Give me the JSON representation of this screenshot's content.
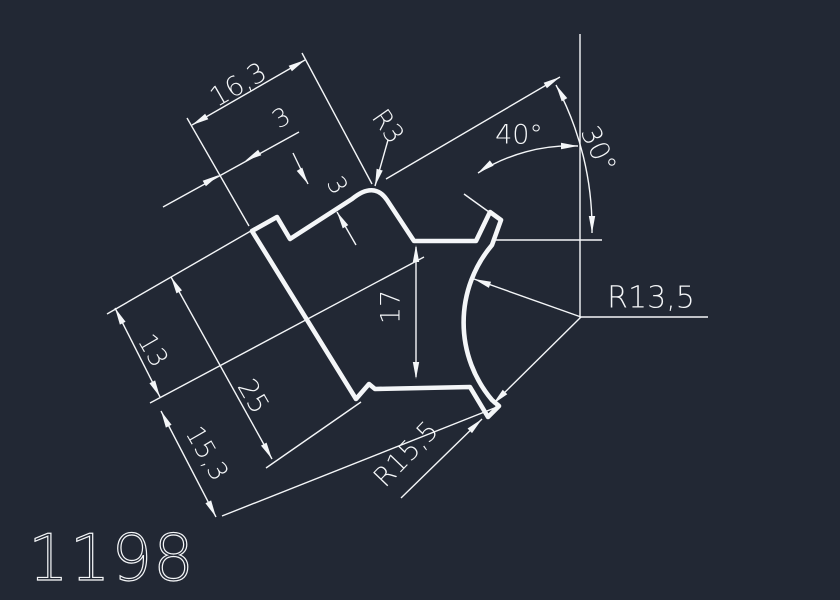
{
  "canvas": {
    "width": 840,
    "height": 600,
    "background_color": "#222834",
    "line_color": "#f4f6f8",
    "thin_stroke": 1.4,
    "thick_stroke": 4.6
  },
  "part_number": "1198",
  "profile": {
    "path": "M 252,231 L 277,217 L 290,239 L 352,199 Q 374,181 387,200 L 414,241 L 476,241 L 490,212 L 501,220 L 492,245 A 120 120 0 0 0 492,400 L 499,406 L 488,417 L 470,387 L 375,389 L 369,384 L 356,399 Z"
  },
  "lines": [
    {
      "name": "ext-line-16-3-left",
      "x1": 187,
      "y1": 118,
      "x2": 249,
      "y2": 226
    },
    {
      "name": "ext-line-16-3-right",
      "x1": 302,
      "y1": 53,
      "x2": 372,
      "y2": 184
    },
    {
      "name": "dim-line-16-3",
      "x1": 192,
      "y1": 125,
      "x2": 305,
      "y2": 60
    },
    {
      "name": "dim-line-3-top",
      "x1": 163,
      "y1": 207,
      "x2": 299,
      "y2": 132
    },
    {
      "name": "stem-3-step-upper",
      "x1": 293,
      "y1": 153,
      "x2": 308,
      "y2": 184
    },
    {
      "name": "stem-3-step-lower",
      "x1": 337,
      "y1": 212,
      "x2": 356,
      "y2": 245
    },
    {
      "name": "leader-r3",
      "x1": 388,
      "y1": 140,
      "x2": 375,
      "y2": 186
    },
    {
      "name": "edge-extension-40deg",
      "x1": 386,
      "y1": 179,
      "x2": 560,
      "y2": 77
    },
    {
      "name": "tab-face-extension",
      "x1": 464,
      "y1": 194,
      "x2": 489,
      "y2": 212
    },
    {
      "name": "vertical-reference",
      "x1": 580,
      "y1": 34,
      "x2": 580,
      "y2": 318
    },
    {
      "name": "horizontal-reference",
      "x1": 496,
      "y1": 240,
      "x2": 602,
      "y2": 240
    },
    {
      "name": "ext-line-25-bottom",
      "x1": 266,
      "y1": 468,
      "x2": 361,
      "y2": 402
    },
    {
      "name": "ext-line-13-25-top",
      "x1": 107,
      "y1": 314,
      "x2": 263,
      "y2": 224
    },
    {
      "name": "dim-line-13",
      "x1": 115,
      "y1": 308,
      "x2": 160,
      "y2": 397
    },
    {
      "name": "dim-line-25",
      "x1": 171,
      "y1": 277,
      "x2": 272,
      "y2": 459
    },
    {
      "name": "dim-line-15-3",
      "x1": 161,
      "y1": 411,
      "x2": 216,
      "y2": 517
    },
    {
      "name": "ext-line-13-15-3-mid",
      "x1": 150,
      "y1": 403,
      "x2": 424,
      "y2": 257
    },
    {
      "name": "ext-line-15-3-bottom",
      "x1": 222,
      "y1": 516,
      "x2": 497,
      "y2": 407
    },
    {
      "name": "dim-line-17",
      "x1": 416,
      "y1": 247,
      "x2": 416,
      "y2": 377
    },
    {
      "name": "leader-r13-5-upper",
      "x1": 581,
      "y1": 317,
      "x2": 474,
      "y2": 279
    },
    {
      "name": "leader-r13-5-lower",
      "x1": 581,
      "y1": 317,
      "x2": 493,
      "y2": 404
    },
    {
      "name": "underline-r13-5",
      "x1": 581,
      "y1": 317,
      "x2": 708,
      "y2": 317
    },
    {
      "name": "leader-r15-5",
      "x1": 401,
      "y1": 498,
      "x2": 482,
      "y2": 419
    }
  ],
  "arcs": [
    {
      "name": "arc-40deg",
      "d": "M 478,173 A 172 172 0 0 1 578,146"
    },
    {
      "name": "arc-30deg",
      "d": "M 556,85 A 305 305 0 0 1 592,233"
    }
  ],
  "arrows": [
    {
      "name": "arrow-16-3-left",
      "x": 192,
      "y": 125,
      "angle": 150
    },
    {
      "name": "arrow-16-3-right",
      "x": 305,
      "y": 60,
      "angle": -30
    },
    {
      "name": "arrow-3-top-left",
      "x": 219,
      "y": 175,
      "angle": -30
    },
    {
      "name": "arrow-3-top-right",
      "x": 245,
      "y": 161,
      "angle": 150
    },
    {
      "name": "arrow-3-step-upper",
      "x": 308,
      "y": 184,
      "angle": 60
    },
    {
      "name": "arrow-3-step-lower",
      "x": 337,
      "y": 212,
      "angle": -120
    },
    {
      "name": "arrow-r3",
      "x": 375,
      "y": 186,
      "angle": 106
    },
    {
      "name": "arrow-edge-ext",
      "x": 560,
      "y": 77,
      "angle": -30
    },
    {
      "name": "arrow-40-start",
      "x": 478,
      "y": 173,
      "angle": 144
    },
    {
      "name": "arrow-40-end",
      "x": 578,
      "y": 146,
      "angle": 0
    },
    {
      "name": "arrow-30-start",
      "x": 556,
      "y": 85,
      "angle": -120
    },
    {
      "name": "arrow-30-end",
      "x": 592,
      "y": 233,
      "angle": 90
    },
    {
      "name": "arrow-13-top",
      "x": 115,
      "y": 308,
      "angle": -117
    },
    {
      "name": "arrow-13-bottom",
      "x": 160,
      "y": 397,
      "angle": 63
    },
    {
      "name": "arrow-25-top",
      "x": 171,
      "y": 277,
      "angle": -119
    },
    {
      "name": "arrow-25-bottom",
      "x": 272,
      "y": 459,
      "angle": 61
    },
    {
      "name": "arrow-15-3-top",
      "x": 161,
      "y": 411,
      "angle": -117
    },
    {
      "name": "arrow-15-3-bottom",
      "x": 216,
      "y": 517,
      "angle": 63
    },
    {
      "name": "arrow-17-top",
      "x": 416,
      "y": 245,
      "angle": -90
    },
    {
      "name": "arrow-17-bottom",
      "x": 416,
      "y": 379,
      "angle": 90
    },
    {
      "name": "arrow-r13-5-upper",
      "x": 474,
      "y": 279,
      "angle": -160
    },
    {
      "name": "arrow-r13-5-lower",
      "x": 493,
      "y": 404,
      "angle": 135
    },
    {
      "name": "arrow-r15-5",
      "x": 482,
      "y": 419,
      "angle": -44
    }
  ],
  "labels": [
    {
      "name": "dim-label-16-3",
      "text": "16,3",
      "x": 239,
      "y": 86,
      "rotate": -30,
      "size": 27
    },
    {
      "name": "dim-label-3-top",
      "text": "3",
      "x": 282,
      "y": 119,
      "rotate": -30,
      "size": 25
    },
    {
      "name": "dim-label-3-step",
      "text": "3",
      "x": 336,
      "y": 186,
      "rotate": 60,
      "size": 25
    },
    {
      "name": "dim-label-r3",
      "text": "R3",
      "x": 387,
      "y": 127,
      "rotate": 55,
      "size": 26
    },
    {
      "name": "dim-label-40deg",
      "text": "40°",
      "x": 519,
      "y": 136,
      "rotate": 0,
      "size": 27
    },
    {
      "name": "dim-label-30deg",
      "text": "30°",
      "x": 597,
      "y": 150,
      "rotate": 65,
      "size": 27
    },
    {
      "name": "dim-label-r13-5",
      "text": "R13,5",
      "x": 651,
      "y": 299,
      "rotate": 0,
      "size": 30
    },
    {
      "name": "dim-label-17",
      "text": "17",
      "x": 392,
      "y": 307,
      "rotate": -90,
      "size": 27
    },
    {
      "name": "dim-label-13",
      "text": "13",
      "x": 152,
      "y": 351,
      "rotate": 60,
      "size": 26
    },
    {
      "name": "dim-label-25",
      "text": "25",
      "x": 252,
      "y": 397,
      "rotate": 60,
      "size": 27
    },
    {
      "name": "dim-label-15-3",
      "text": "15,3",
      "x": 206,
      "y": 454,
      "rotate": 60,
      "size": 26
    },
    {
      "name": "dim-label-r15-5",
      "text": "R15,5",
      "x": 407,
      "y": 455,
      "rotate": -46,
      "size": 27
    }
  ],
  "part_number_style": {
    "x": 28,
    "y": 580,
    "size": 64,
    "letter_spacing": 1
  }
}
